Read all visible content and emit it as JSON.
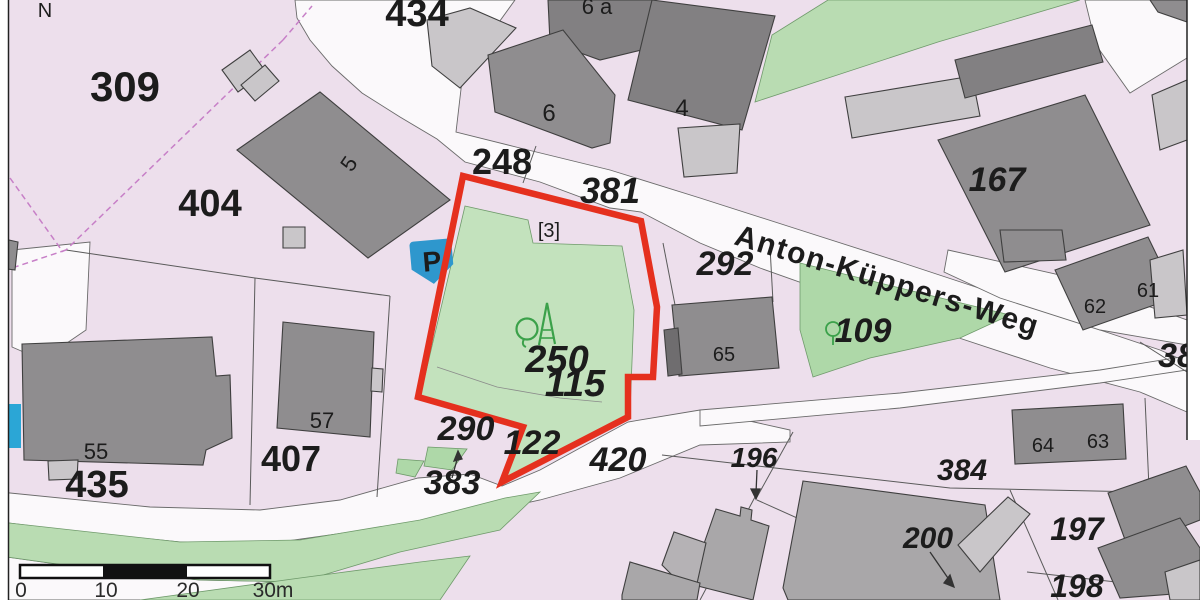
{
  "map": {
    "type_note": "cadastral parcel map extract",
    "north_indicator": "N",
    "street": {
      "name": "Anton-Küppers-Weg"
    },
    "parking_symbol": "P",
    "highlighted_parcel": {
      "outline_color": "#e5301e",
      "inner_label": "[3]"
    }
  },
  "parcel_labels": {
    "p309": "309",
    "p404": "404",
    "p434": "434",
    "p248": "248",
    "p381": "381",
    "p292": "292",
    "p167": "167",
    "p109": "109",
    "p250": "250",
    "p115": "115",
    "p290": "290",
    "p122": "122",
    "p420": "420",
    "p383": "383",
    "p196": "196",
    "p384": "384",
    "p200": "200",
    "p197": "197",
    "p198": "198",
    "p38": "38",
    "p435": "435",
    "p407": "407",
    "p3": "[3]"
  },
  "house_numbers": {
    "h4": "4",
    "h5": "5",
    "h6": "6",
    "h6a": "6 a",
    "h55": "55",
    "h57": "57",
    "h65": "65",
    "h61": "61",
    "h62": "62",
    "h63": "63",
    "h64": "64"
  },
  "scale_bar": {
    "t0": "0",
    "t10": "10",
    "t20": "20",
    "t30": "30m"
  },
  "colors": {
    "background_pink": "#eddfec",
    "road_white": "#fbf9fb",
    "parcel_green": "#c3e2bd",
    "green_strip": "#b9dcb2",
    "building_dark": "#8f8d8f",
    "building_darker": "#828082",
    "building_light": "#c9c6c9",
    "outline_red": "#e5301e",
    "parking_blue": "#2e97cd",
    "boundary_magenta": "#c77fc7",
    "tree_green": "#3ba14a"
  }
}
